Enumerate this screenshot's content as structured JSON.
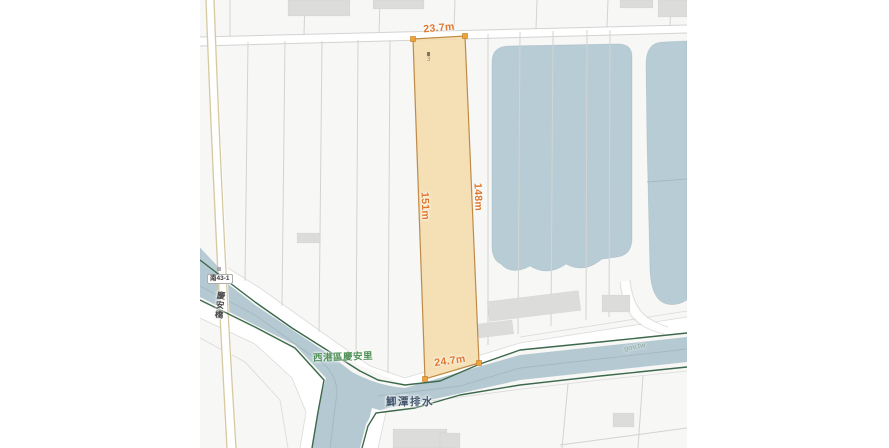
{
  "colors": {
    "map-bg": "#f7f7f5",
    "line": "#d2d4d2",
    "building": "#dcdcda",
    "pond": "#b8ccd5",
    "canal": "#b5c9d2",
    "water-line": "#9fb4be",
    "green": "#3c684c",
    "beige": "#d6c9a0",
    "parcel-fill": "#f5dcaa",
    "parcel-edge": "#bf8a45",
    "marker": "#efa23a",
    "measure": "#e0772e",
    "road-name": "#4f9157",
    "canal-name": "#44586e",
    "plate-text": "#3a3a3a",
    "bridge-text": "#4a4a4a",
    "watermark": "#7e9c8b"
  },
  "measurements": {
    "top": "23.7m",
    "bottom": "24.7m",
    "left": "151m",
    "right": "148m"
  },
  "labels": {
    "road_name": "西港區慶安里",
    "canal_name": "鯽潭排水",
    "road_number": "南43-1",
    "bridge_name": "慶安橋",
    "watermark": "gov.tw",
    "parcel_note": "3"
  }
}
